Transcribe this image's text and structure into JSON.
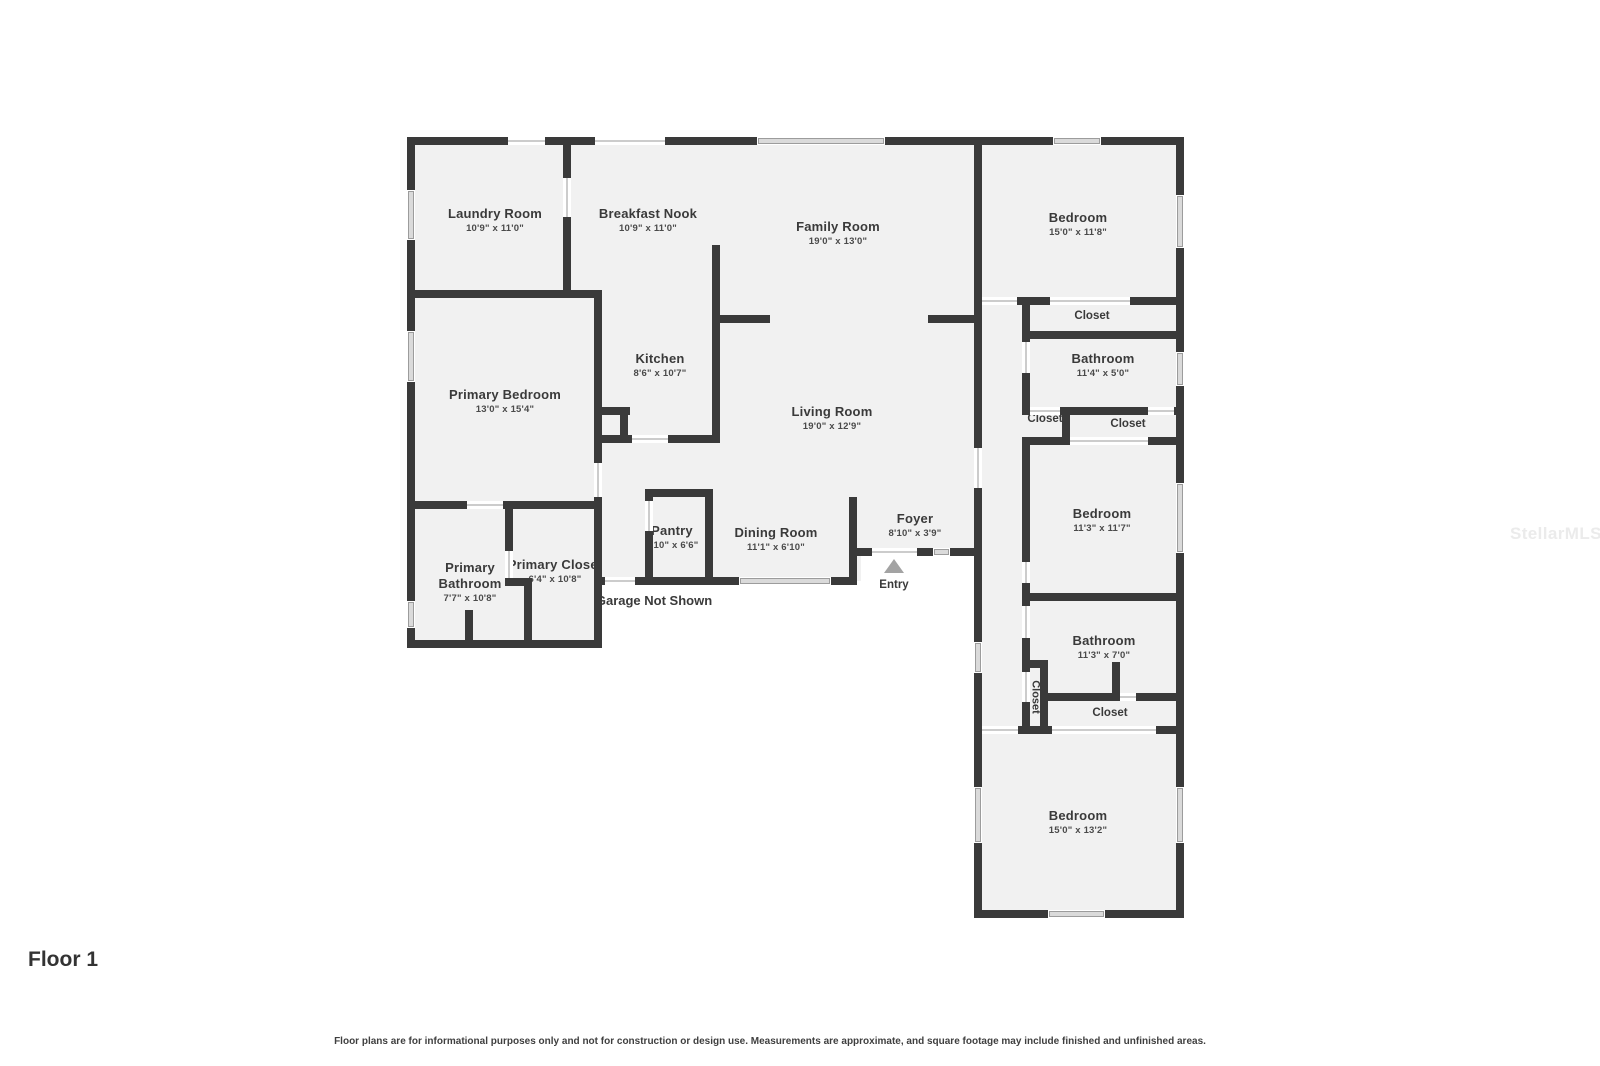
{
  "floor_label": "Floor 1",
  "watermark": "StellarMLS",
  "footer": {
    "disclaimer": "Floor plans are for informational purposes only and not for construction or design use. Measurements are approximate, and square footage may include finished and unfinished areas."
  },
  "plan": {
    "entry_label": "Entry",
    "garage_note": "Garage Not Shown",
    "rooms": {
      "laundry": {
        "name": "Laundry Room",
        "dims": "10'9\" x 11'0\""
      },
      "breakfast_nook": {
        "name": "Breakfast Nook",
        "dims": "10'9\" x 11'0\""
      },
      "family_room": {
        "name": "Family Room",
        "dims": "19'0\" x 13'0\""
      },
      "bedroom_top": {
        "name": "Bedroom",
        "dims": "15'0\" x 11'8\""
      },
      "closet_top": {
        "name": "Closet"
      },
      "bathroom_top": {
        "name": "Bathroom",
        "dims": "11'4\" x 5'0\""
      },
      "kitchen": {
        "name": "Kitchen",
        "dims": "8'6\" x 10'7\""
      },
      "primary_bedroom": {
        "name": "Primary Bedroom",
        "dims": "13'0\" x 15'4\""
      },
      "living_room": {
        "name": "Living Room",
        "dims": "19'0\" x 12'9\""
      },
      "closet_hall_left": {
        "name": "Closet"
      },
      "closet_hall_right": {
        "name": "Closet"
      },
      "bedroom_middle": {
        "name": "Bedroom",
        "dims": "11'3\" x 11'7\""
      },
      "pantry": {
        "name": "Pantry",
        "dims": "3'10\" x 6'6\""
      },
      "dining_room": {
        "name": "Dining Room",
        "dims": "11'1\" x 6'10\""
      },
      "foyer": {
        "name": "Foyer",
        "dims": "8'10\" x 3'9\""
      },
      "primary_bathroom": {
        "name_line1": "Primary",
        "name_line2": "Bathroom",
        "dims": "7'7\" x 10'8\""
      },
      "primary_closet": {
        "name": "Primary Closet",
        "dims": "6'4\" x 10'8\""
      },
      "bathroom_middle": {
        "name": "Bathroom",
        "dims": "11'3\" x 7'0\""
      },
      "closet_vertical": {
        "name": "Closet"
      },
      "closet_bottom": {
        "name": "Closet"
      },
      "bedroom_bottom": {
        "name": "Bedroom",
        "dims": "15'0\" x 13'2\""
      }
    }
  }
}
